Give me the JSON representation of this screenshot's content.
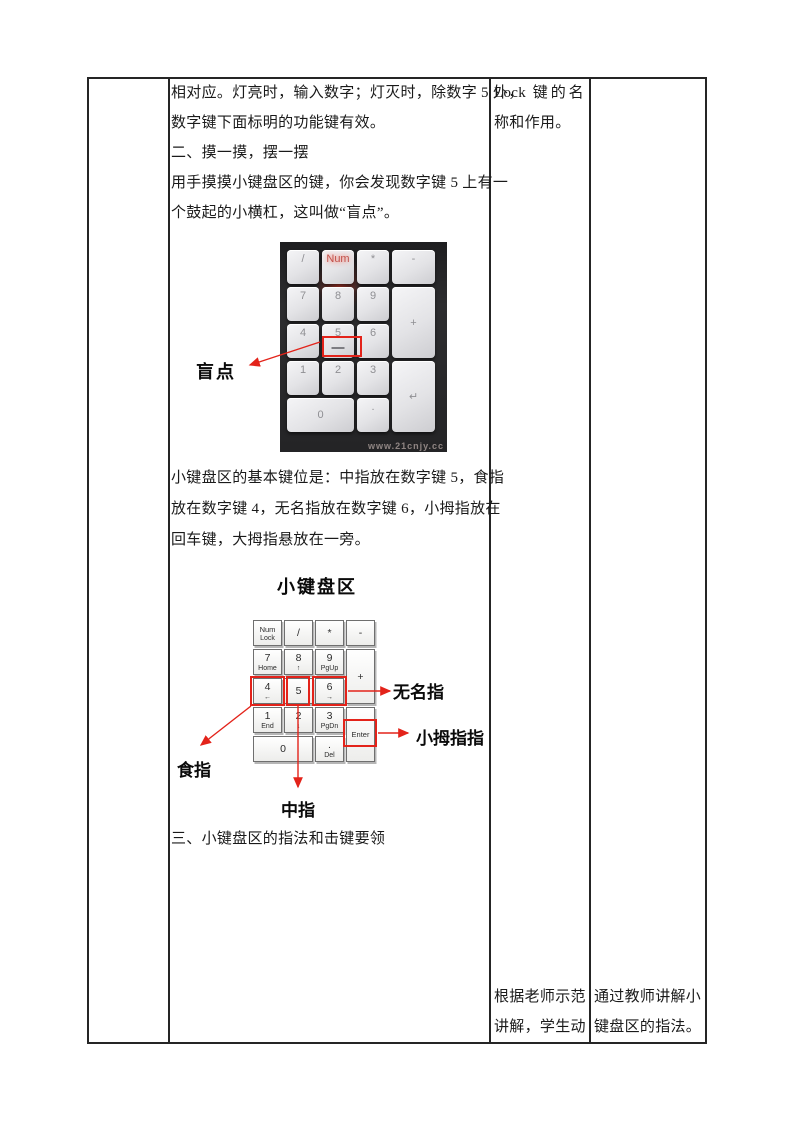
{
  "accent_red": "#e3231a",
  "table": {
    "content": {
      "para_top": [
        "相对应。灯亮时，输入数字；灯灭时，除数字 5 外，",
        "数字键下面标明的功能键有效。",
        "二、摸一摸，摆一摆",
        "用手摸摸小键盘区的键，你会发现数字键 5 上有一",
        "个鼓起的小横杠，这叫做“盲点”。"
      ],
      "para_mid": [
        "小键盘区的基本键位是：中指放在数字键 5，食指",
        "放在数字键 4，无名指放在数字键 6，小拇指放在",
        "回车键，大拇指悬放在一旁。"
      ],
      "section3": "三、小键盘区的指法和击键要领"
    },
    "col3_top": [
      "Lock 键的名",
      "称和作用。"
    ],
    "col3_bottom": [
      "根据老师示范",
      "讲解，学生动"
    ],
    "col4_bottom": [
      "通过教师讲解小",
      "键盘区的指法。"
    ]
  },
  "photo_figure": {
    "blind_label": "盲点",
    "watermark": "www.21cnjy.cc",
    "keys": [
      {
        "label": "/",
        "col": 1,
        "row": 1
      },
      {
        "label": "Num",
        "col": 2,
        "row": 1,
        "accent": true
      },
      {
        "label": "*",
        "col": 3,
        "row": 1
      },
      {
        "label": "-",
        "col": 4,
        "row": 1
      },
      {
        "label": "7",
        "col": 1,
        "row": 2
      },
      {
        "label": "8",
        "col": 2,
        "row": 2
      },
      {
        "label": "9",
        "col": 3,
        "row": 2
      },
      {
        "label": "+",
        "col": 4,
        "row": 2,
        "rowspan": 2
      },
      {
        "label": "4",
        "col": 1,
        "row": 3
      },
      {
        "label": "5",
        "col": 2,
        "row": 3,
        "bump": true
      },
      {
        "label": "6",
        "col": 3,
        "row": 3
      },
      {
        "label": "1",
        "col": 1,
        "row": 4
      },
      {
        "label": "2",
        "col": 2,
        "row": 4
      },
      {
        "label": "3",
        "col": 3,
        "row": 4
      },
      {
        "label": "↵",
        "col": 4,
        "row": 4,
        "rowspan": 2
      },
      {
        "label": "0",
        "col": 1,
        "row": 5,
        "colspan": 2
      },
      {
        "label": ".",
        "col": 3,
        "row": 5
      }
    ]
  },
  "diagram_figure": {
    "title": "小键盘区",
    "finger_labels": {
      "ring": "无名指",
      "pinky": "小拇指指",
      "index": "食指",
      "middle": "中指"
    },
    "keys": [
      {
        "top": "Num",
        "bottom": "Lock",
        "col": 1,
        "row": 1
      },
      {
        "top": "/",
        "col": 2,
        "row": 1
      },
      {
        "top": "*",
        "col": 3,
        "row": 1
      },
      {
        "top": "-",
        "col": 4,
        "row": 1
      },
      {
        "top": "7",
        "bottom": "Home",
        "col": 1,
        "row": 2
      },
      {
        "top": "8",
        "bottom": "↑",
        "col": 2,
        "row": 2
      },
      {
        "top": "9",
        "bottom": "PgUp",
        "col": 3,
        "row": 2
      },
      {
        "top": "+",
        "col": 4,
        "row": 2,
        "rowspan": 2
      },
      {
        "top": "4",
        "bottom": "←",
        "col": 1,
        "row": 3
      },
      {
        "top": "5",
        "col": 2,
        "row": 3
      },
      {
        "top": "6",
        "bottom": "→",
        "col": 3,
        "row": 3
      },
      {
        "top": "1",
        "bottom": "End",
        "col": 1,
        "row": 4
      },
      {
        "top": "2",
        "bottom": "↓",
        "col": 2,
        "row": 4
      },
      {
        "top": "3",
        "bottom": "PgDn",
        "col": 3,
        "row": 4
      },
      {
        "top": "Enter",
        "col": 4,
        "row": 4,
        "rowspan": 2
      },
      {
        "top": "0",
        "col": 1,
        "row": 5,
        "colspan": 2
      },
      {
        "top": ".",
        "bottom": "Del",
        "col": 3,
        "row": 5
      }
    ]
  }
}
